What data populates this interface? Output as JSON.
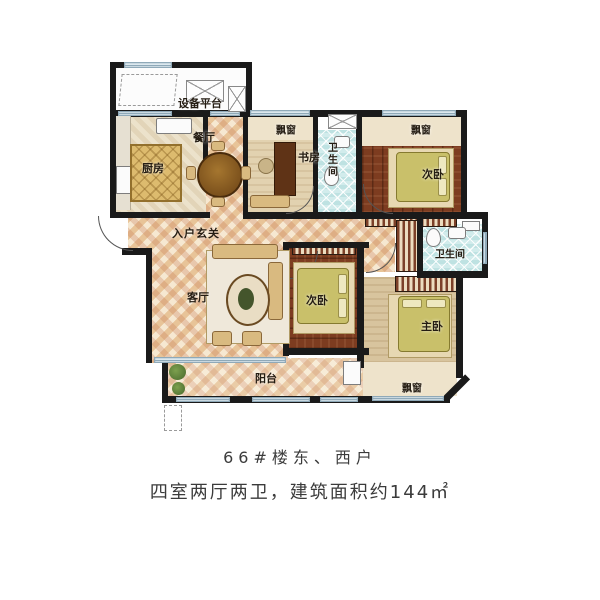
{
  "plan": {
    "labels": {
      "equipment_platform": "设备平台",
      "kitchen": "厨房",
      "dining": "餐厅",
      "bay_window_study": "飘窗",
      "study": "书房",
      "bath_top": "卫生间",
      "bay_window_top_right": "飘窗",
      "bedroom_top_right": "次卧",
      "entry_hall": "入户玄关",
      "living": "客厅",
      "bedroom_center": "次卧",
      "bath_right": "卫生间",
      "master_bedroom": "主卧",
      "balcony": "阳台",
      "bay_window_master": "飘窗"
    },
    "colors": {
      "wall": "#1a1a1a",
      "tile_floor": "#ecd3ab",
      "wood_floor": "#7d3c20",
      "bath_tile": "#d2ecec",
      "bay_cream": "#eee3cb",
      "bed_green": "#c9c06a",
      "window_blue": "#dce8ee"
    }
  },
  "caption": {
    "line1": "66#楼东、西户",
    "line2": "四室两厅两卫，建筑面积约144㎡"
  }
}
